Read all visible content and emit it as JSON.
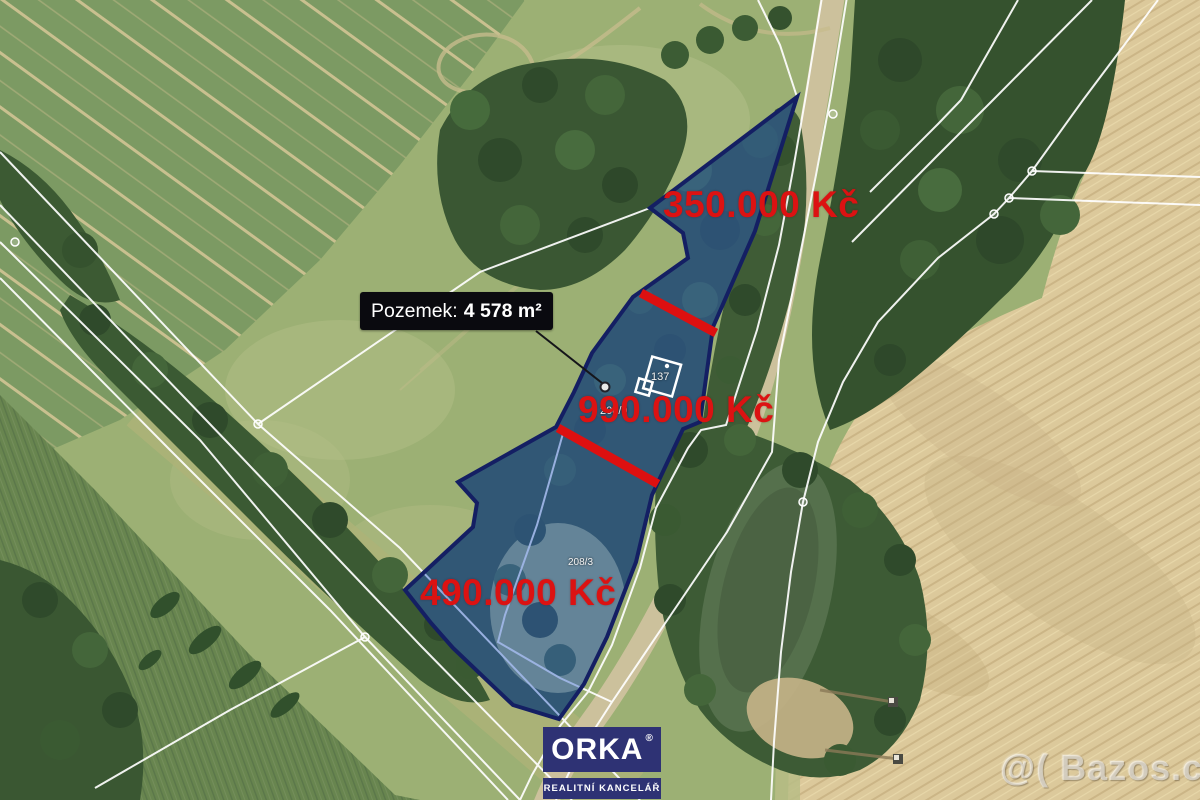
{
  "annotations": {
    "area_label": {
      "prefix": "Pozemek:",
      "value": "4 578 m²"
    },
    "prices": {
      "north": "350.000 Kč",
      "middle": "990.000 Kč",
      "south": "490.000 Kč"
    },
    "parcel_numbers": {
      "building": "137",
      "middle": "208/9",
      "south": "208/3"
    }
  },
  "branding": {
    "logo_text": "ORKA",
    "logo_reg": "®",
    "logo_subtitle": "REALITNÍ KANCELÁŘ"
  },
  "watermark": {
    "text": "@( Bazos.cz"
  },
  "colors": {
    "price_red": "#dc1212",
    "divider_red": "#dd1010",
    "parcel_fill": "rgba(45,95,205,0.45)",
    "parcel_border": "#141f63",
    "label_bg": "#0a0a0f",
    "label_text": "#ffffff",
    "brand_navy": "#2e3274",
    "cadastral_white": "#ffffff"
  }
}
